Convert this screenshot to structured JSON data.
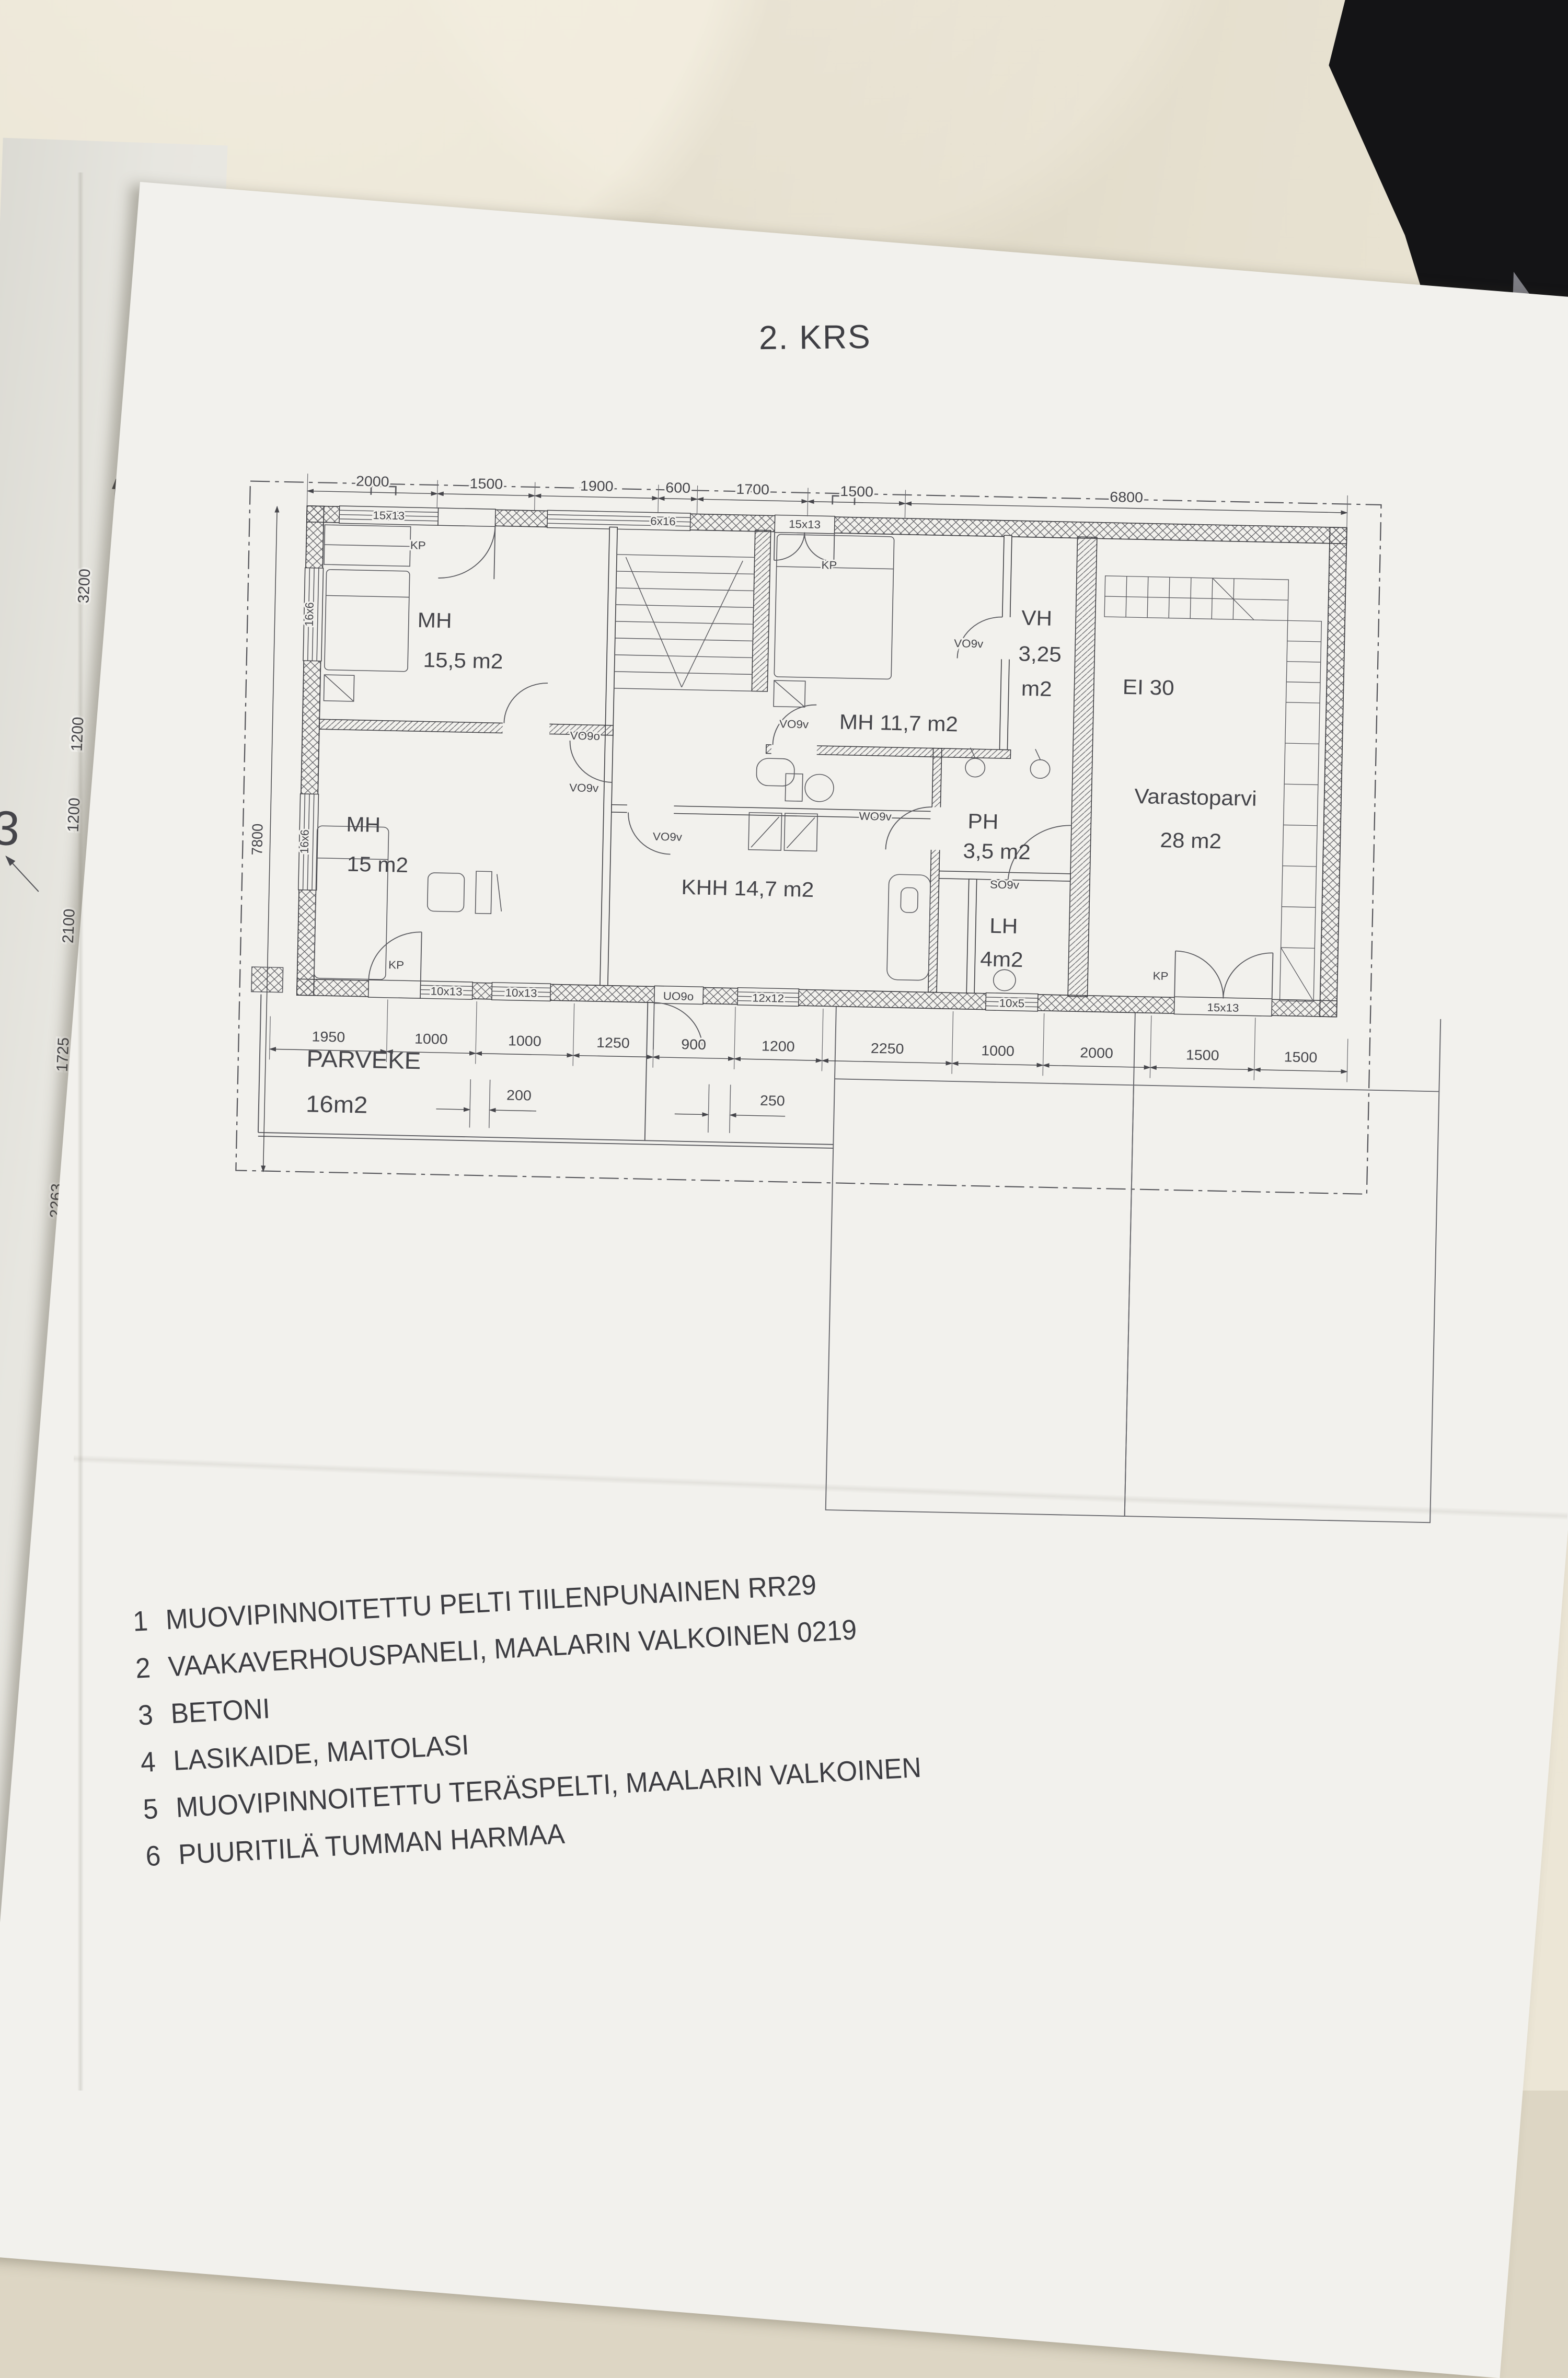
{
  "title": "2. KRS",
  "rooms": {
    "mh1": {
      "name": "MH",
      "area": "15,5 m2"
    },
    "mh2": {
      "label": "MH 11,7 m2"
    },
    "mh3": {
      "name": "MH",
      "area": "15 m2"
    },
    "vh": {
      "name": "VH",
      "area1": "3,25",
      "area2": "m2"
    },
    "ei30": "EI 30",
    "varasto": {
      "name": "Varastoparvi",
      "area": "28 m2"
    },
    "khh": {
      "label": "KHH 14,7 m2"
    },
    "ph": {
      "name": "PH",
      "area": "3,5 m2"
    },
    "lh": {
      "name": "LH",
      "area": "4m2"
    },
    "parveke": {
      "name": "PARVEKE",
      "area": "16m2"
    }
  },
  "openings": {
    "kp": "KP",
    "vo9o": "VO9o",
    "vo9v": "VO9v",
    "wo9v": "WO9v",
    "so9v": "SO9v",
    "uo9o": "UO9o"
  },
  "windows": {
    "w15x13": "15x13",
    "w6x16": "6x16",
    "w16x6": "16x6",
    "w10x13": "10x13",
    "w12x12": "12x12",
    "w10x5": "10x5"
  },
  "dims": {
    "top": [
      "2000",
      "1500",
      "1900",
      "600",
      "1700",
      "1500",
      "6800"
    ],
    "bottom": [
      "1950",
      "1000",
      "1000",
      "1250",
      "900",
      "1200",
      "2250",
      "1000",
      "2000",
      "1500",
      "1500"
    ],
    "bottom2": [
      "200",
      "250"
    ],
    "left_total": "7800",
    "left_chain": [
      "3200",
      "1200",
      "1200",
      "2100",
      "1725",
      "2263"
    ]
  },
  "fragment": {
    "partial3": "3"
  },
  "legend": [
    {
      "num": "1",
      "text": "MUOVIPINNOITETTU PELTI TIILENPUNAINEN RR29"
    },
    {
      "num": "2",
      "text": "VAAKAVERHOUSPANELI, MAALARIN VALKOINEN 0219"
    },
    {
      "num": "3",
      "text": "BETONI"
    },
    {
      "num": "4",
      "text": "LASIKAIDE, MAITOLASI"
    },
    {
      "num": "5",
      "text": "MUOVIPINNOITETTU TERÄSPELTI, MAALARIN VALKOINEN"
    },
    {
      "num": "6",
      "text": "PUURITILÄ TUMMAN HARMAA"
    }
  ],
  "colors": {
    "paper": "#f2f1ed",
    "ink": "#45454a",
    "wall_bg": "#ddd6c4",
    "dark_object": "#141416"
  }
}
